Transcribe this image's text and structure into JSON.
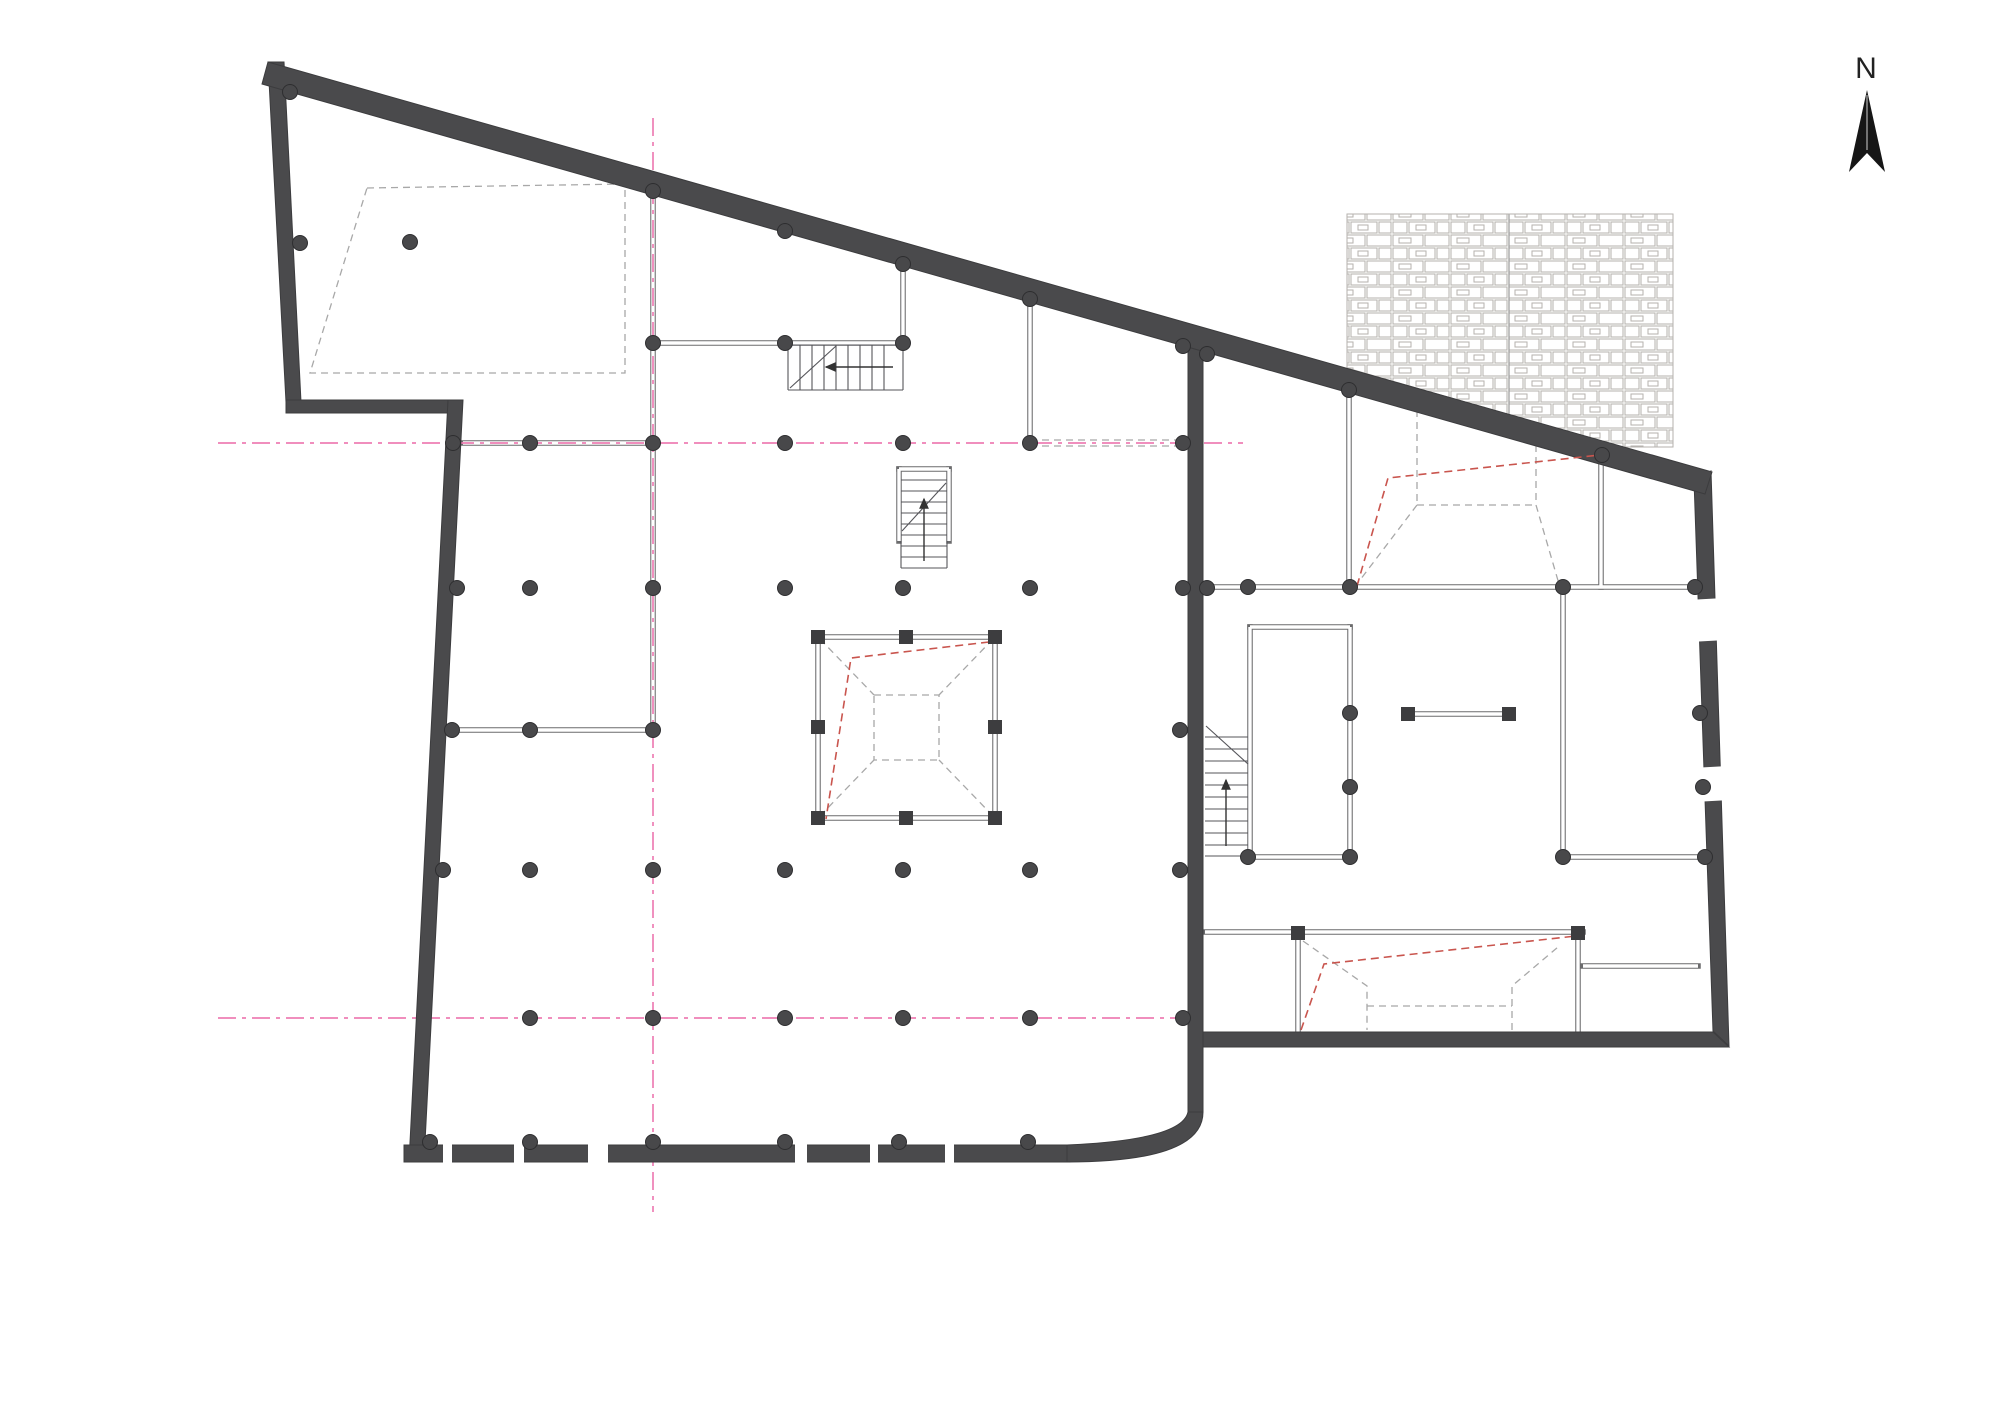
{
  "north": {
    "label": "N"
  },
  "colors": {
    "wall": "#4a4a4c",
    "thin_wall": "#6b6b6d",
    "line": "#55555a",
    "axis_pink": "#ee7eb4",
    "red_dash": "#c9554e",
    "gray_dash": "#a8a8a8",
    "column": "#48484a",
    "stone_line": "#b5b2ae",
    "paper": "#ffffff"
  },
  "plan": {
    "axis_lines": [
      [
        653,
        118,
        653,
        1212
      ],
      [
        218,
        443,
        1243,
        443
      ],
      [
        218,
        1018,
        1195,
        1018
      ]
    ],
    "columns": [
      [
        290,
        92
      ],
      [
        653,
        191
      ],
      [
        785,
        231
      ],
      [
        903,
        264
      ],
      [
        1030,
        299
      ],
      [
        1183,
        346
      ],
      [
        1207,
        354
      ],
      [
        300,
        243
      ],
      [
        410,
        242
      ],
      [
        653,
        343
      ],
      [
        785,
        343
      ],
      [
        903,
        343
      ],
      [
        453,
        443
      ],
      [
        530,
        443
      ],
      [
        653,
        443
      ],
      [
        785,
        443
      ],
      [
        903,
        443
      ],
      [
        1030,
        443
      ],
      [
        1183,
        443
      ],
      [
        457,
        588
      ],
      [
        530,
        588
      ],
      [
        653,
        588
      ],
      [
        785,
        588
      ],
      [
        903,
        588
      ],
      [
        1030,
        588
      ],
      [
        1183,
        588
      ],
      [
        1207,
        588
      ],
      [
        452,
        730
      ],
      [
        530,
        730
      ],
      [
        653,
        730
      ],
      [
        1180,
        730
      ],
      [
        1248,
        587
      ],
      [
        1350,
        587
      ],
      [
        1563,
        587
      ],
      [
        1695,
        587
      ],
      [
        1349,
        390
      ],
      [
        1602,
        455
      ],
      [
        1350,
        713
      ],
      [
        1700,
        713
      ],
      [
        1350,
        787
      ],
      [
        1703,
        787
      ],
      [
        1248,
        857
      ],
      [
        1350,
        857
      ],
      [
        1563,
        857
      ],
      [
        1705,
        857
      ],
      [
        443,
        870
      ],
      [
        530,
        870
      ],
      [
        653,
        870
      ],
      [
        785,
        870
      ],
      [
        903,
        870
      ],
      [
        1030,
        870
      ],
      [
        1180,
        870
      ],
      [
        530,
        1018
      ],
      [
        653,
        1018
      ],
      [
        785,
        1018
      ],
      [
        903,
        1018
      ],
      [
        1030,
        1018
      ],
      [
        1183,
        1018
      ],
      [
        430,
        1142
      ],
      [
        530,
        1142
      ],
      [
        653,
        1142
      ],
      [
        785,
        1142
      ],
      [
        899,
        1142
      ],
      [
        1028,
        1142
      ]
    ],
    "square_markers": [
      [
        818,
        637
      ],
      [
        906,
        637
      ],
      [
        995,
        637
      ],
      [
        818,
        727
      ],
      [
        995,
        727
      ],
      [
        818,
        818
      ],
      [
        906,
        818
      ],
      [
        995,
        818
      ],
      [
        1408,
        714
      ],
      [
        1509,
        714
      ],
      [
        1298,
        933
      ],
      [
        1578,
        933
      ]
    ],
    "thin_walls": [
      [
        653,
        191,
        653,
        730
      ],
      [
        653,
        343,
        903,
        343
      ],
      [
        903,
        250,
        903,
        343
      ],
      [
        463,
        443,
        653,
        443
      ],
      [
        447,
        730,
        653,
        730
      ],
      [
        1030,
        300,
        1030,
        443
      ],
      [
        1205,
        587,
        1695,
        587
      ],
      [
        1250,
        627,
        1250,
        857
      ],
      [
        1350,
        627,
        1350,
        857
      ],
      [
        1250,
        627,
        1350,
        627
      ],
      [
        1248,
        857,
        1352,
        857
      ],
      [
        1563,
        587,
        1563,
        857
      ],
      [
        1563,
        857,
        1712,
        857
      ],
      [
        1349,
        390,
        1349,
        587
      ],
      [
        1601,
        457,
        1601,
        587
      ],
      [
        1205,
        932,
        1583,
        932
      ],
      [
        1298,
        932,
        1298,
        1032
      ],
      [
        1578,
        932,
        1578,
        1032
      ],
      [
        1583,
        966,
        1698,
        966
      ],
      [
        1414,
        714,
        1506,
        714
      ],
      [
        899,
        469,
        949,
        469
      ],
      [
        899,
        469,
        899,
        541
      ],
      [
        949,
        469,
        949,
        541
      ],
      [
        818,
        637,
        995,
        637
      ],
      [
        995,
        637,
        995,
        818
      ],
      [
        818,
        818,
        995,
        818
      ],
      [
        818,
        637,
        818,
        818
      ]
    ],
    "thin_lines": [
      [
        788,
        345,
        903,
        345
      ],
      [
        788,
        390,
        903,
        390
      ],
      [
        788,
        345,
        788,
        390
      ],
      [
        903,
        345,
        903,
        390
      ],
      [
        800,
        345,
        800,
        390
      ],
      [
        812,
        345,
        812,
        390
      ],
      [
        824,
        345,
        824,
        390
      ],
      [
        836,
        345,
        836,
        390
      ],
      [
        848,
        345,
        848,
        390
      ],
      [
        860,
        345,
        860,
        390
      ],
      [
        872,
        345,
        872,
        390
      ],
      [
        884,
        345,
        884,
        390
      ],
      [
        790,
        388,
        836,
        346
      ],
      [
        901,
        480,
        947,
        480
      ],
      [
        901,
        491,
        947,
        491
      ],
      [
        901,
        502,
        947,
        502
      ],
      [
        901,
        513,
        947,
        513
      ],
      [
        901,
        524,
        947,
        524
      ],
      [
        901,
        535,
        947,
        535
      ],
      [
        901,
        546,
        947,
        546
      ],
      [
        901,
        557,
        947,
        557
      ],
      [
        901,
        568,
        947,
        568
      ],
      [
        901,
        541,
        901,
        568
      ],
      [
        947,
        541,
        947,
        568
      ],
      [
        902,
        531,
        946,
        483
      ],
      [
        1205,
        737,
        1248,
        737
      ],
      [
        1205,
        749,
        1248,
        749
      ],
      [
        1205,
        761,
        1248,
        761
      ],
      [
        1205,
        773,
        1248,
        773
      ],
      [
        1205,
        785,
        1248,
        785
      ],
      [
        1205,
        797,
        1248,
        797
      ],
      [
        1205,
        809,
        1248,
        809
      ],
      [
        1205,
        821,
        1248,
        821
      ],
      [
        1205,
        833,
        1248,
        833
      ],
      [
        1205,
        845,
        1248,
        845
      ],
      [
        1205,
        856,
        1248,
        856
      ],
      [
        1206,
        726,
        1248,
        764
      ]
    ],
    "gray_dashed": [
      [
        [
          367,
          188
        ],
        [
          625,
          184
        ],
        [
          625,
          373
        ],
        [
          310,
          373
        ],
        [
          367,
          188
        ]
      ],
      [
        [
          820,
          639
        ],
        [
          874,
          695
        ]
      ],
      [
        [
          993,
          639
        ],
        [
          939,
          695
        ]
      ],
      [
        [
          820,
          816
        ],
        [
          874,
          760
        ]
      ],
      [
        [
          993,
          816
        ],
        [
          939,
          760
        ]
      ],
      [
        [
          874,
          695
        ],
        [
          939,
          695
        ],
        [
          939,
          760
        ],
        [
          874,
          760
        ],
        [
          874,
          695
        ]
      ],
      [
        [
          1417,
          398
        ],
        [
          1417,
          505
        ]
      ],
      [
        [
          1536,
          445
        ],
        [
          1536,
          505
        ]
      ],
      [
        [
          1417,
          505
        ],
        [
          1536,
          505
        ]
      ],
      [
        [
          1417,
          505
        ],
        [
          1357,
          584
        ]
      ],
      [
        [
          1536,
          505
        ],
        [
          1559,
          584
        ]
      ],
      [
        [
          1303,
          941
        ],
        [
          1367,
          986
        ],
        [
          1367,
          1030
        ]
      ],
      [
        [
          1512,
          1030
        ],
        [
          1512,
          986
        ],
        [
          1558,
          947
        ]
      ],
      [
        [
          1367,
          1006
        ],
        [
          1512,
          1006
        ]
      ],
      [
        [
          1030,
          440
        ],
        [
          1183,
          440
        ]
      ],
      [
        [
          1030,
          446
        ],
        [
          1183,
          446
        ]
      ]
    ],
    "red_dashed": [
      [
        [
          989,
          642
        ],
        [
          851,
          658
        ],
        [
          826,
          819
        ]
      ],
      [
        [
          1357,
          586
        ],
        [
          1388,
          478
        ],
        [
          1600,
          455
        ]
      ],
      [
        [
          1301,
          1030
        ],
        [
          1324,
          964
        ],
        [
          1576,
          936
        ]
      ]
    ],
    "arrows": [
      [
        893,
        367,
        826,
        367
      ],
      [
        924,
        561,
        924,
        499
      ],
      [
        1226,
        846,
        1226,
        780
      ]
    ],
    "openings": {
      "rects": [
        [
          443,
          1141,
          9,
          25
        ],
        [
          514,
          1141,
          10,
          25
        ],
        [
          588,
          1141,
          20,
          25
        ],
        [
          795,
          1141,
          12,
          25
        ],
        [
          870,
          1141,
          8,
          25
        ],
        [
          945,
          1141,
          9,
          25
        ]
      ],
      "polys": [
        [
          [
            1688,
            600
          ],
          [
            1724,
            598
          ],
          [
            1726,
            640
          ],
          [
            1690,
            642
          ]
        ],
        [
          [
            1692,
            768
          ],
          [
            1728,
            766
          ],
          [
            1730,
            800
          ],
          [
            1694,
            802
          ]
        ]
      ]
    }
  }
}
